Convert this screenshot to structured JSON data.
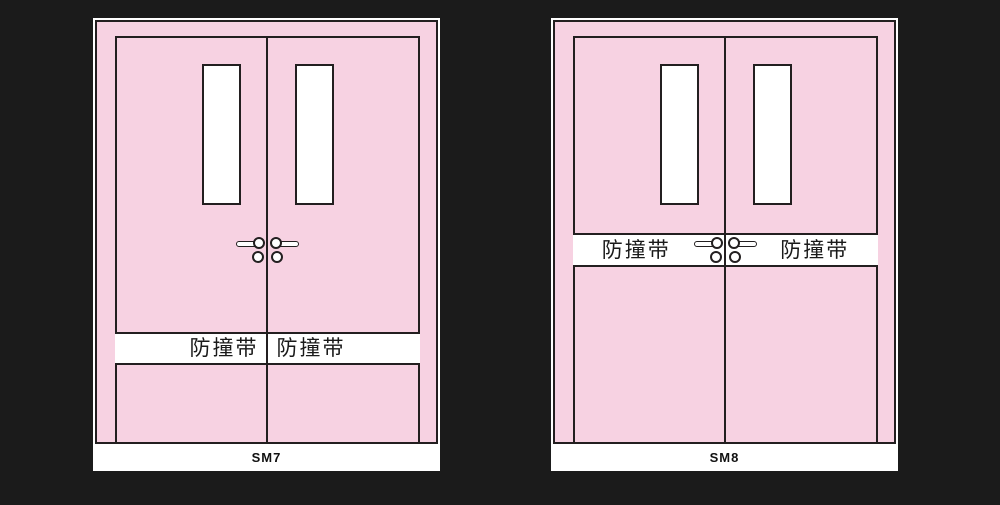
{
  "background_color": "#1b1b1b",
  "colors": {
    "door_fill": "#f7d2e2",
    "outline": "#231f20",
    "panel_white": "#ffffff",
    "text": "#1a1a1a"
  },
  "doors": [
    {
      "code": "SM7",
      "strip_position": "bottom",
      "strip_labels": [
        "防撞带",
        "防撞带"
      ]
    },
    {
      "code": "SM8",
      "strip_position": "middle",
      "strip_labels": [
        "防撞带",
        "防撞带"
      ]
    }
  ]
}
